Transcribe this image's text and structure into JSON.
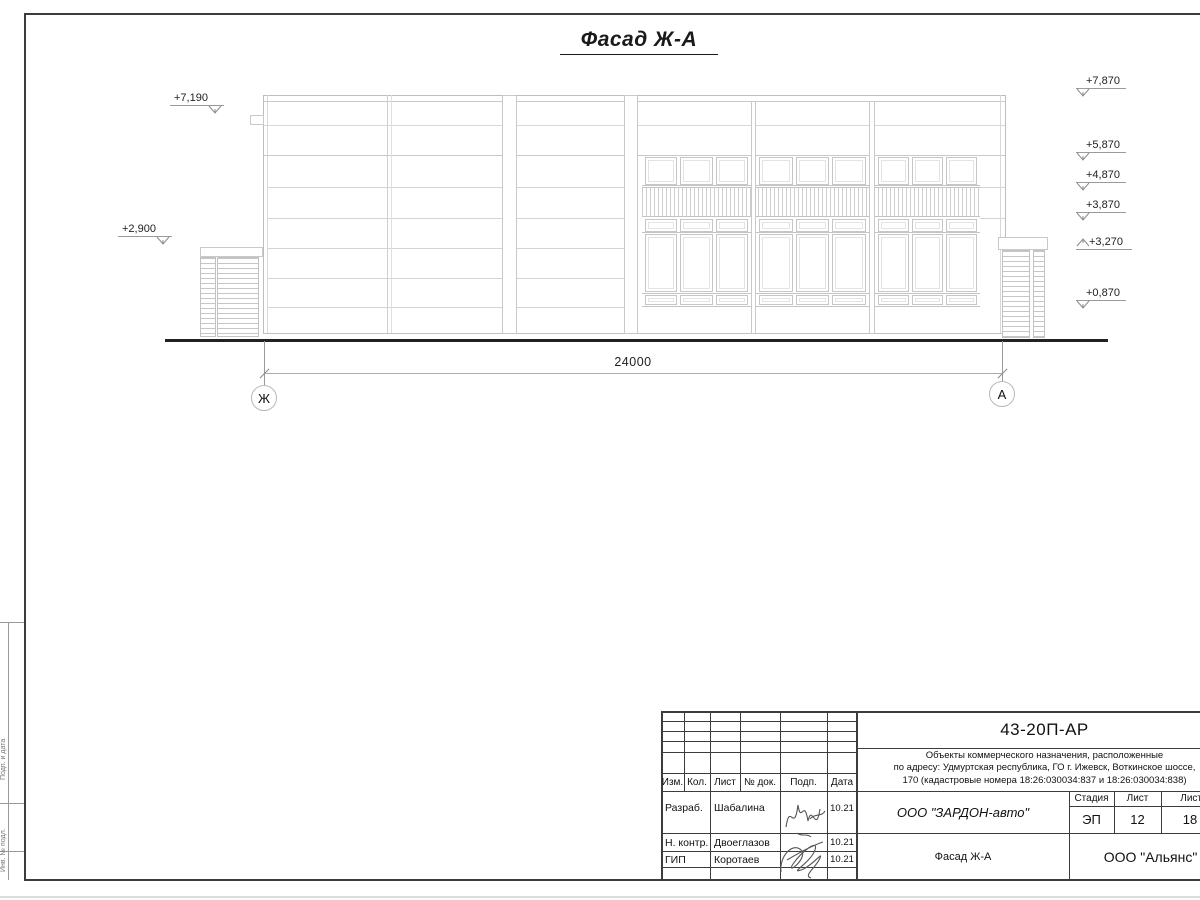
{
  "sheet": {
    "title": "Фасад Ж-А"
  },
  "dimension": {
    "value": "24000"
  },
  "axes": {
    "left": "Ж",
    "right": "А"
  },
  "marks": {
    "left": [
      {
        "value": "+7,190"
      },
      {
        "value": "+2,900"
      }
    ],
    "right": [
      {
        "value": "+7,870"
      },
      {
        "value": "+5,870"
      },
      {
        "value": "+4,870"
      },
      {
        "value": "+3,870"
      },
      {
        "value": "+3,270"
      },
      {
        "value": "+0,870"
      }
    ]
  },
  "titleblock": {
    "doc_code": "43-20П-АР",
    "project_line1": "Объекты коммерческого назначения, расположенные",
    "project_line2": "по адресу: Удмуртская республика, ГО г. Ижевск, Воткинское шоссе,",
    "project_line3": "170 (кадастровые номера 18:26:030034:837 и 18:26:030034:838)",
    "headers": {
      "izm": "Изм.",
      "kol": "Кол.",
      "list": "Лист",
      "doc": "№ док.",
      "podp": "Подп.",
      "data": "Дата"
    },
    "rows": [
      {
        "role": "Разраб.",
        "name": "Шабалина",
        "date": "10.21"
      },
      {
        "role": "Н. контр.",
        "name": "Двоеглазов",
        "date": "10.21"
      },
      {
        "role": "ГИП",
        "name": "Коротаев",
        "date": "10.21"
      }
    ],
    "company": "ООО \"ЗАРДОН-авто\"",
    "sheet_name": "Фасад Ж-А",
    "stage_label": "Стадия",
    "list_label": "Лист",
    "lists_label": "Листов",
    "stage": "ЭП",
    "list_no": "12",
    "lists_total": "18",
    "org": "ООО \"Альянс\""
  },
  "margin": {
    "label_top": "Подп. и дата",
    "label_bottom": "Инв. № подл."
  }
}
